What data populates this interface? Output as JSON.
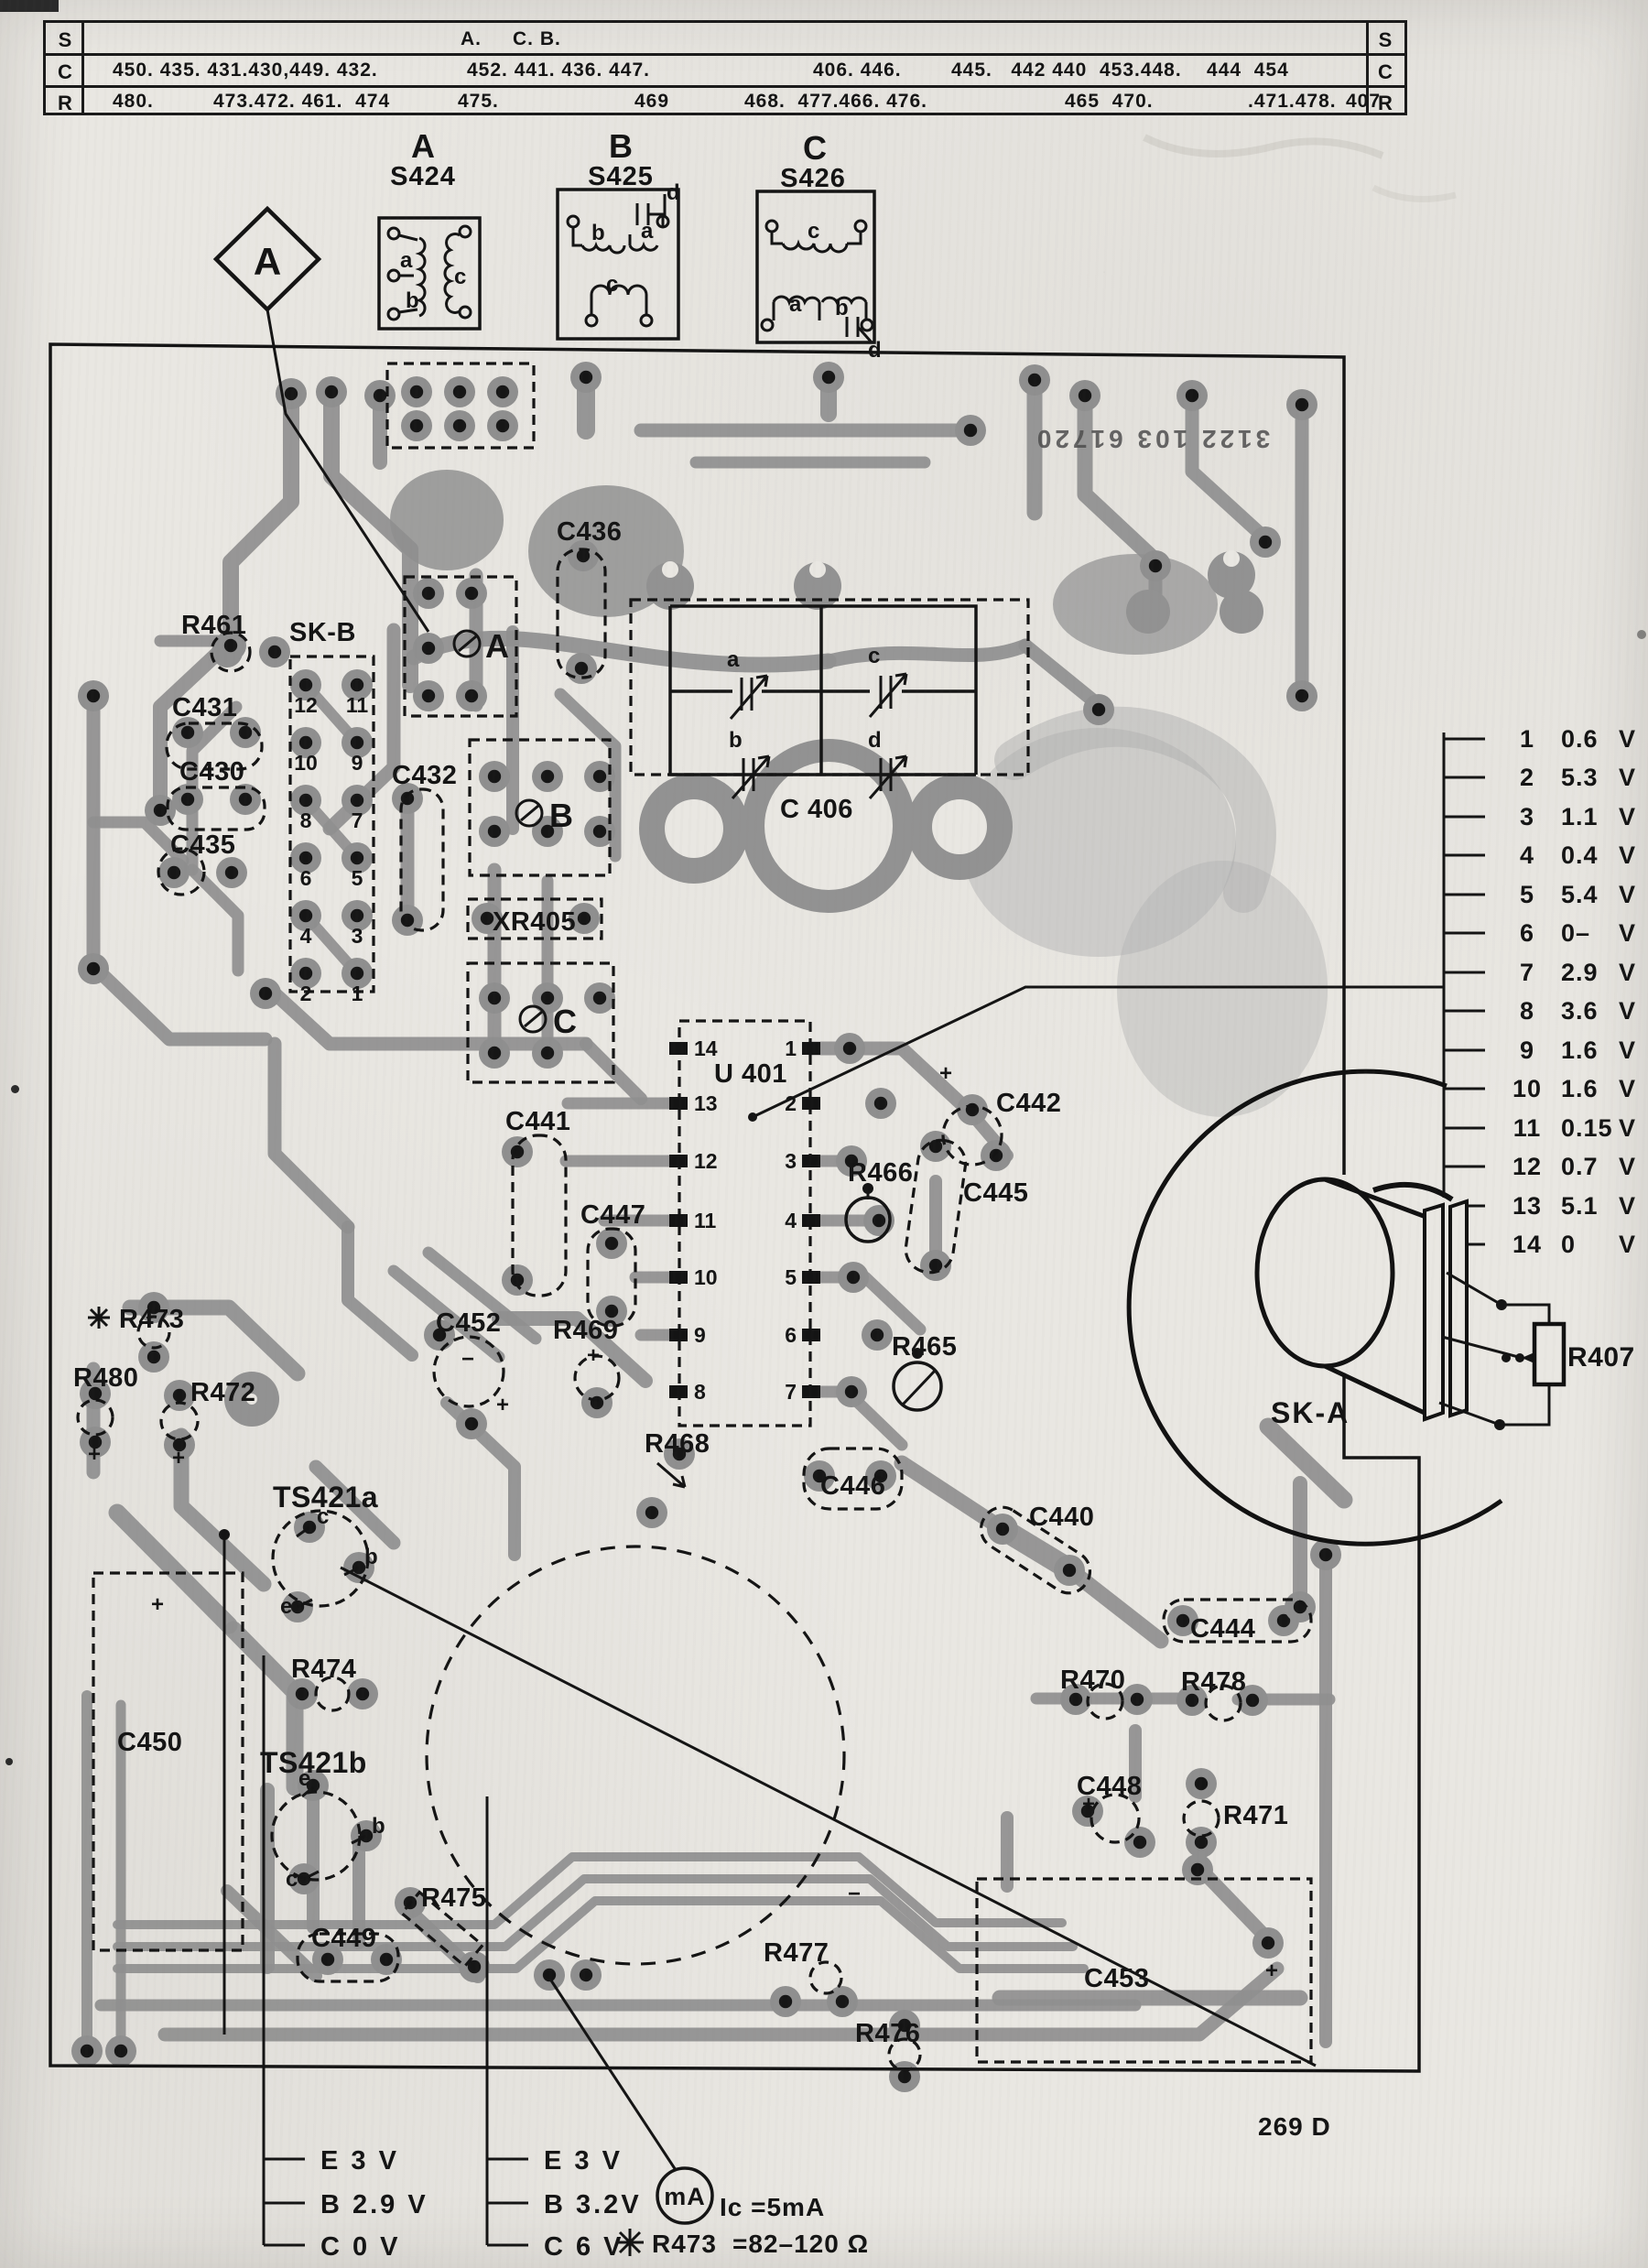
{
  "doc": {
    "part_number": "3122 103 61720",
    "page_ref": "269 D"
  },
  "ref_table": {
    "col_headers": [
      "S",
      "C",
      "R"
    ],
    "s_row": [
      "A.",
      "C. B."
    ],
    "c_row": [
      "450. 435. 431.430,449. 432.",
      "452. 441. 436. 447.",
      "406. 446.",
      "445.   442 440  453.448.    444  454"
    ],
    "r_row": [
      "480.",
      "473.472. 461.  474",
      "475.",
      "469",
      "468.  477.466. 476.",
      "465  470.",
      ".471.478.",
      "407"
    ]
  },
  "switch_details": {
    "a": {
      "letter": "A",
      "ref": "S424",
      "coil_a": "a",
      "coil_b": "b",
      "coil_c": "c"
    },
    "b": {
      "letter": "B",
      "ref": "S425",
      "coil_a": "a",
      "coil_b": "b",
      "coil_c": "c",
      "term_d": "d"
    },
    "c": {
      "letter": "C",
      "ref": "S426",
      "coil_a": "a",
      "coil_b": "b",
      "coil_c": "c",
      "term_d": "d"
    }
  },
  "callout_a": "A",
  "board": {
    "labels": {
      "c436": "C436",
      "r461": "R461",
      "skb": "SK-B",
      "c431": "C431",
      "c430": "C430",
      "c435": "C435",
      "c432": "C432",
      "sw_a": "A",
      "sw_b": "B",
      "sw_c": "C",
      "xr405": "XR405",
      "c406": "C 406",
      "u401": "U 401",
      "c441": "C441",
      "c447": "C447",
      "r469": "R469",
      "r468": "R468",
      "c446": "C446",
      "r466": "R466",
      "c442": "C442",
      "c445": "C445",
      "r465": "R465",
      "c452": "C452",
      "r473": "R473",
      "r480": "R480",
      "r472": "R472",
      "ts421a": "TS421a",
      "c450": "C450",
      "r474": "R474",
      "ts421b": "TS421b",
      "c449": "C449",
      "r475": "R475",
      "c440": "C440",
      "c444": "C444",
      "r470": "R470",
      "r478": "R478",
      "c448": "C448",
      "r471": "R471",
      "r477": "R477",
      "r476": "R476",
      "c453": "C453"
    },
    "sk_b_pins": [
      "12",
      "11",
      "10",
      "9",
      "8",
      "7",
      "6",
      "5",
      "4",
      "3",
      "2",
      "1"
    ],
    "u401_pins_left": [
      "14",
      "13",
      "12",
      "11",
      "10",
      "9",
      "8"
    ],
    "u401_pins_right": [
      "1",
      "2",
      "3",
      "4",
      "5",
      "6",
      "7"
    ],
    "c406_trimmers": [
      "a",
      "b",
      "c",
      "d"
    ],
    "ts421a_pins": [
      "c",
      "b",
      "e"
    ],
    "ts421b_pins": [
      "e",
      "b",
      "c"
    ],
    "signs": {
      "plus": "+",
      "minus": "−"
    }
  },
  "voltage_list": {
    "unit": "V",
    "rows": [
      {
        "pin": "1",
        "value": "0.6"
      },
      {
        "pin": "2",
        "value": "5.3"
      },
      {
        "pin": "3",
        "value": "1.1"
      },
      {
        "pin": "4",
        "value": "0.4"
      },
      {
        "pin": "5",
        "value": "5.4"
      },
      {
        "pin": "6",
        "value": "0–"
      },
      {
        "pin": "7",
        "value": "2.9"
      },
      {
        "pin": "8",
        "value": "3.6"
      },
      {
        "pin": "9",
        "value": "1.6"
      },
      {
        "pin": "10",
        "value": "1.6"
      },
      {
        "pin": "11",
        "value": "0.15"
      },
      {
        "pin": "12",
        "value": "0.7"
      },
      {
        "pin": "13",
        "value": "5.1"
      },
      {
        "pin": "14",
        "value": "0"
      }
    ]
  },
  "sk_a": {
    "label": "SK-A",
    "pot_label": "R407"
  },
  "legend_ts421a": {
    "rows": [
      "E  3  V",
      "B  2.9 V",
      "C  0  V"
    ]
  },
  "legend_ts421b": {
    "rows": [
      "E  3  V",
      "B  3.2V",
      "C  6  V"
    ]
  },
  "measure_notes": {
    "meter": "mA",
    "ic": "Ic =5mA",
    "r473_ref": "R473",
    "r473_value": "=82–120 Ω"
  }
}
